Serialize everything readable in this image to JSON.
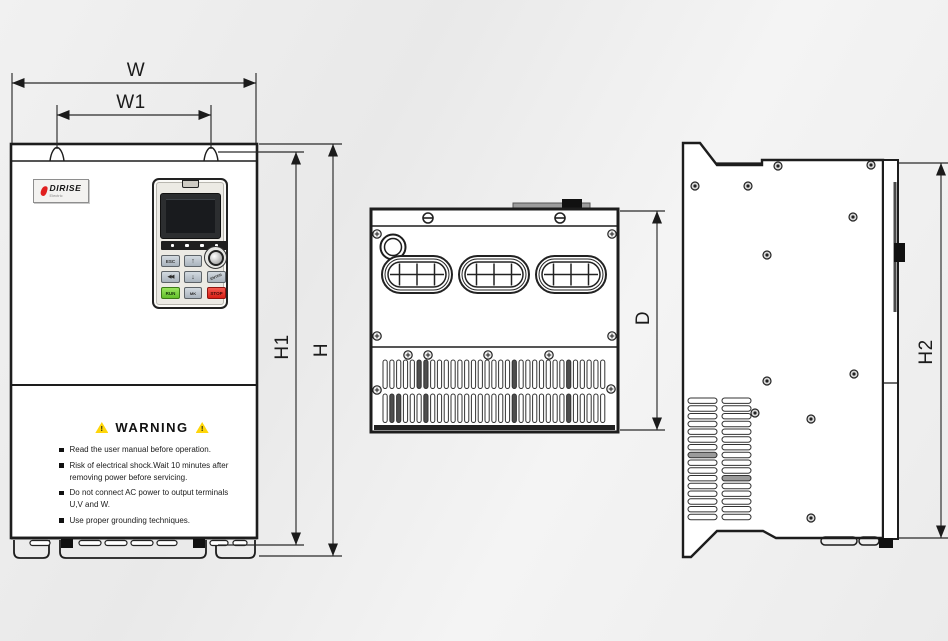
{
  "dimension_labels": {
    "w": "W",
    "w1": "W1",
    "h1": "H1",
    "h": "H",
    "d": "D",
    "h2": "H2"
  },
  "front_view": {
    "logo": {
      "brand": "DIRISE",
      "tagline": "Electric"
    },
    "keypad": {
      "buttons": {
        "esc": "ESC",
        "up": "↑",
        "shift": "◀◀",
        "down": "↓",
        "enter": "ENTER",
        "run": "RUN",
        "mk": "MK",
        "stop": "STOP"
      }
    },
    "warning": {
      "title": "WARNING",
      "icon_glyph": "!",
      "items": [
        "Read the user manual before operation.",
        "Risk of electrical shock.Wait 10 minutes after removing power before servicing.",
        "Do not connect AC power to output terminals U,V and W.",
        "Use proper grounding techniques."
      ]
    }
  },
  "colors": {
    "line": "#1d1d1d",
    "run_green": "#7cd13d",
    "stop_red": "#e73026",
    "warning_yellow": "#ffd60a",
    "logo_red": "#e01f1f",
    "background": "#ededed"
  }
}
